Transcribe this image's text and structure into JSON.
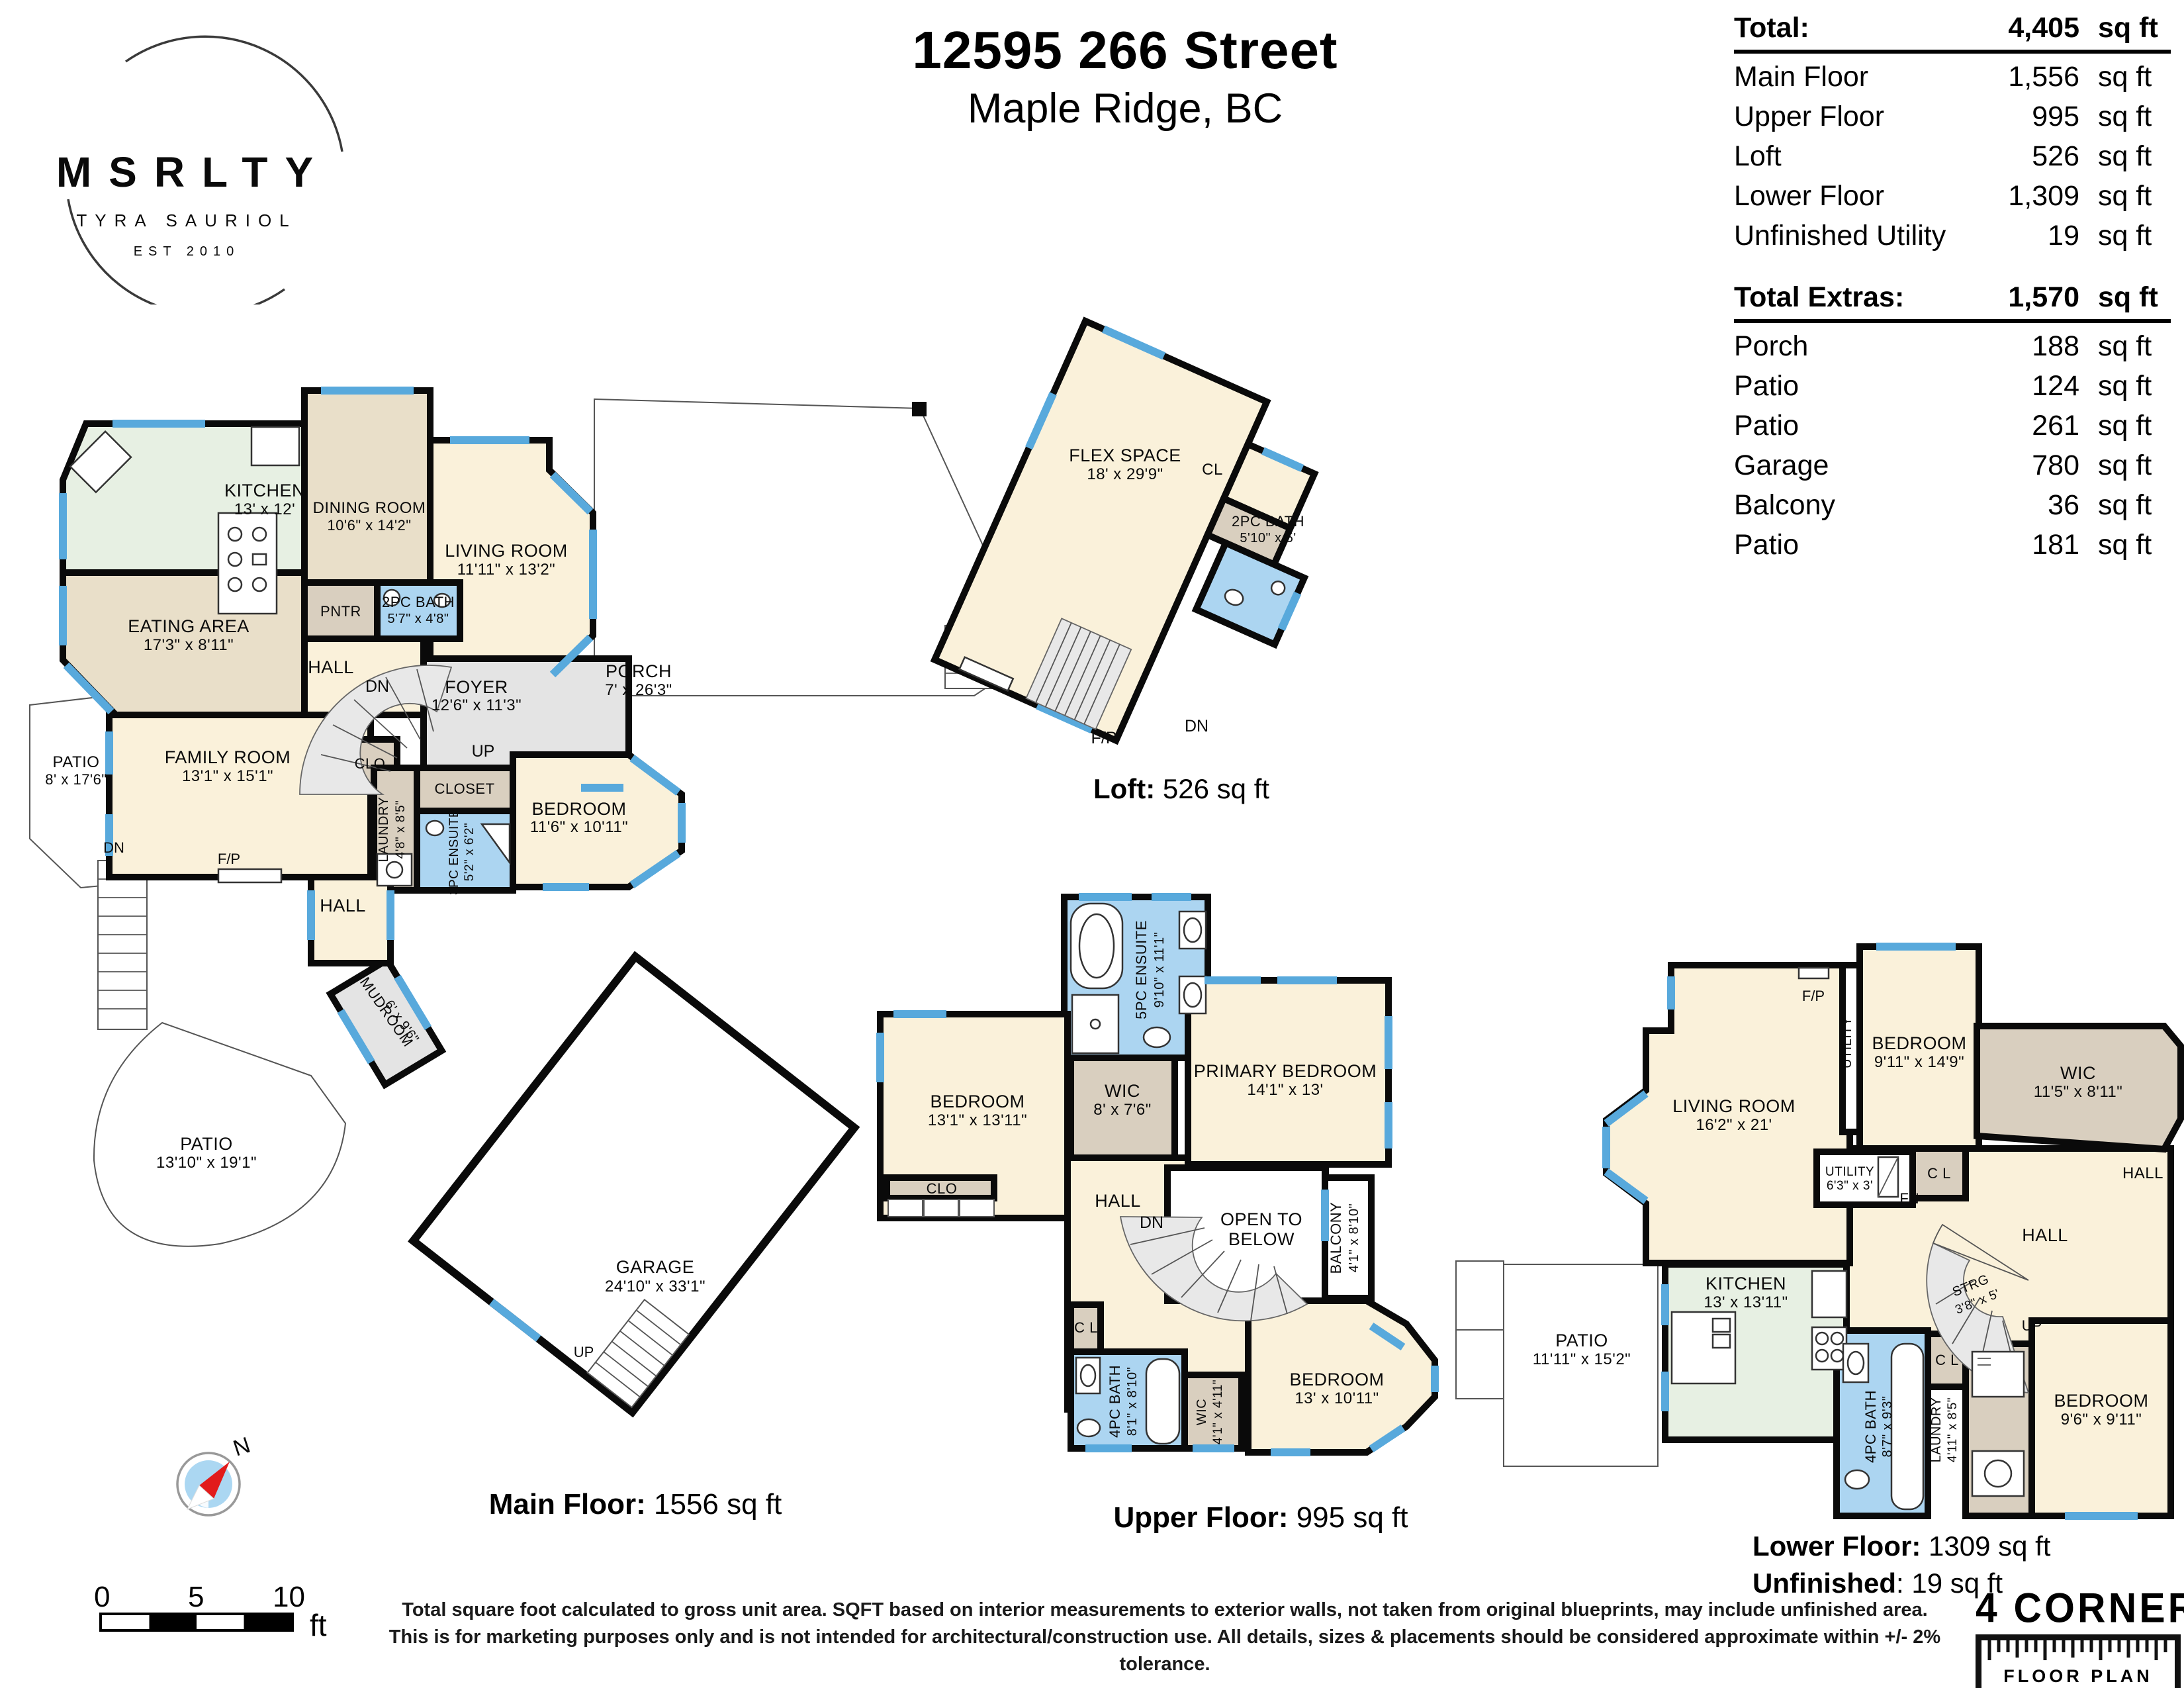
{
  "header": {
    "title_line1": "12595 266 Street",
    "title_line2": "Maple Ridge, BC"
  },
  "logo": {
    "brand": "MSRLTY",
    "name": "TYRA SAURIOL",
    "est": "EST 2010"
  },
  "area_table": {
    "header": {
      "label": "Total:",
      "value": "4,405",
      "unit": "sq ft"
    },
    "rows": [
      {
        "label": "Main Floor",
        "value": "1,556",
        "unit": "sq ft"
      },
      {
        "label": "Upper Floor",
        "value": "995",
        "unit": "sq ft"
      },
      {
        "label": "Loft",
        "value": "526",
        "unit": "sq ft"
      },
      {
        "label": "Lower Floor",
        "value": "1,309",
        "unit": "sq ft"
      },
      {
        "label": "Unfinished Utility",
        "value": "19",
        "unit": "sq ft"
      }
    ]
  },
  "extras_table": {
    "header": {
      "label": "Total Extras:",
      "value": "1,570",
      "unit": "sq ft"
    },
    "rows": [
      {
        "label": "Porch",
        "value": "188",
        "unit": "sq ft"
      },
      {
        "label": "Patio",
        "value": "124",
        "unit": "sq ft"
      },
      {
        "label": "Patio",
        "value": "261",
        "unit": "sq ft"
      },
      {
        "label": "Garage",
        "value": "780",
        "unit": "sq ft"
      },
      {
        "label": "Balcony",
        "value": "36",
        "unit": "sq ft"
      },
      {
        "label": "Patio",
        "value": "181",
        "unit": "sq ft"
      }
    ]
  },
  "markers": {
    "fp": "F/P",
    "dn": "DN",
    "up": "UP",
    "fn": "FN"
  },
  "floors": {
    "main": {
      "caption": {
        "bold": "Main Floor:",
        "text": " 1556 sq ft"
      },
      "rooms": {
        "kitchen": {
          "name": "KITCHEN",
          "dims": "13' x 12'"
        },
        "dining": {
          "name": "DINING ROOM",
          "dims": "10'6\" x 14'2\""
        },
        "living": {
          "name": "LIVING ROOM",
          "dims": "11'11\" x 13'2\""
        },
        "eating": {
          "name": "EATING AREA",
          "dims": "17'3\" x 8'11\""
        },
        "pantry": {
          "name": "PNTR"
        },
        "bath2pc": {
          "name": "2PC BATH",
          "dims": "5'7\" x 4'8\""
        },
        "hall_upper": {
          "name": "HALL"
        },
        "foyer": {
          "name": "FOYER",
          "dims": "12'6\" x 11'3\""
        },
        "porch": {
          "name": "PORCH",
          "dims": "7' x 26'3\""
        },
        "patio_upper": {
          "name": "PATIO",
          "dims": "8' x 17'6\""
        },
        "family": {
          "name": "FAMILY ROOM",
          "dims": "13'1\" x 15'1\""
        },
        "clo": {
          "name": "CLO"
        },
        "closet": {
          "name": "CLOSET"
        },
        "laundry": {
          "name": "LAUNDRY",
          "dims": "4'8\" x 8'5\""
        },
        "ensuite3pc": {
          "name": "3PC ENSUITE",
          "dims": "5'2\" x 6'2\""
        },
        "bedroom": {
          "name": "BEDROOM",
          "dims": "11'6\" x 10'11\""
        },
        "hall_lower": {
          "name": "HALL"
        },
        "mudroom": {
          "name": "MUDROOM",
          "dims": "6' x 9'6\""
        },
        "patio_lower": {
          "name": "PATIO",
          "dims": "13'10\" x 19'1\""
        },
        "garage": {
          "name": "GARAGE",
          "dims": "24'10\" x 33'1\""
        }
      }
    },
    "loft": {
      "caption": {
        "bold": "Loft:",
        "text": " 526 sq ft"
      },
      "rooms": {
        "flex": {
          "name": "FLEX SPACE",
          "dims": "18' x 29'9\""
        },
        "cl": {
          "name": "CL"
        },
        "bath2pc": {
          "name": "2PC BATH",
          "dims": "5'10\" x 5'"
        }
      }
    },
    "upper": {
      "caption": {
        "bold": "Upper Floor:",
        "text": " 995 sq ft"
      },
      "rooms": {
        "ensuite5pc": {
          "name": "5PC ENSUITE",
          "dims": "9'10\" x 11'1\""
        },
        "bedroom_left": {
          "name": "BEDROOM",
          "dims": "13'1\" x 13'11\""
        },
        "clo": {
          "name": "CLO"
        },
        "wic": {
          "name": "WIC",
          "dims": "8' x 7'6\""
        },
        "primary": {
          "name": "PRIMARY BEDROOM",
          "dims": "14'1\" x 13'"
        },
        "hall": {
          "name": "HALL"
        },
        "open_below": {
          "line1": "OPEN TO",
          "line2": "BELOW"
        },
        "balcony": {
          "name": "BALCONY",
          "dims": "4'1\" x 8'10\""
        },
        "cl": {
          "name": "C L"
        },
        "bath4pc": {
          "name": "4PC BATH",
          "dims": "8'1\" x 8'10\""
        },
        "wic_small": {
          "name": "WIC",
          "dims": "4'1\" x 4'11\""
        },
        "bedroom_right": {
          "name": "BEDROOM",
          "dims": "13' x 10'11\""
        }
      }
    },
    "lower": {
      "caption": {
        "bold": "Lower Floor:",
        "text": " 1309 sq ft"
      },
      "caption2": {
        "bold": "Unfinished",
        "text": ": 19 sq ft"
      },
      "rooms": {
        "living": {
          "name": "LIVING ROOM",
          "dims": "16'2\" x 21'"
        },
        "utility_side": {
          "name": "UTILITY"
        },
        "bedroom_top": {
          "name": "BEDROOM",
          "dims": "9'11\" x 14'9\""
        },
        "cl_top": {
          "name": "C L"
        },
        "utility_fn": {
          "name": "UTILITY",
          "dims": "6'3\" x 3'"
        },
        "hall_top": {
          "name": "HALL"
        },
        "wic": {
          "name": "WIC",
          "dims": "11'5\" x 8'11\""
        },
        "hall": {
          "name": "HALL"
        },
        "strg": {
          "name": "STRG",
          "dims": "3'8\" x 5'"
        },
        "kitchen": {
          "name": "KITCHEN",
          "dims": "13' x 13'11\""
        },
        "patio": {
          "name": "PATIO",
          "dims": "11'11\" x 15'2\""
        },
        "bath4pc": {
          "name": "4PC BATH",
          "dims": "8'7\" x 9'3\""
        },
        "cl_bath": {
          "name": "C L"
        },
        "laundry": {
          "name": "LAUNDRY",
          "dims": "4'11\" x 8'5\""
        },
        "bedroom_bottom": {
          "name": "BEDROOM",
          "dims": "9'6\" x 9'11\""
        }
      }
    }
  },
  "scale_bar": {
    "ticks": [
      "0",
      "5",
      "10"
    ],
    "unit": "ft"
  },
  "compass": {
    "north": "N"
  },
  "disclaimer": {
    "line1": "Total square foot calculated to gross unit area. SQFT based on interior measurements to exterior walls, not taken from original blueprints, may include unfinished area.",
    "line2": "This is for marketing purposes only and is not intended for architectural/construction use.  All details, sizes & placements should be considered approximate within +/- 2%  tolerance."
  },
  "footer_logo": {
    "title": "4 CORNERS",
    "subtitle": "FLOOR PLAN"
  },
  "colors": {
    "wall": "#0a0a0a",
    "cream": "#FAF1DA",
    "tan": "#E9DFC9",
    "taupe": "#D9CFBF",
    "green": "#E7F0E3",
    "bath": "#ACD5F1",
    "window": "#58A9DC",
    "room_gray": "#E4E4E4",
    "stair_gray": "#E8E8E8",
    "thin_line": "#555555",
    "compass": "#ABD7F2",
    "needle": "#E21B1B"
  }
}
